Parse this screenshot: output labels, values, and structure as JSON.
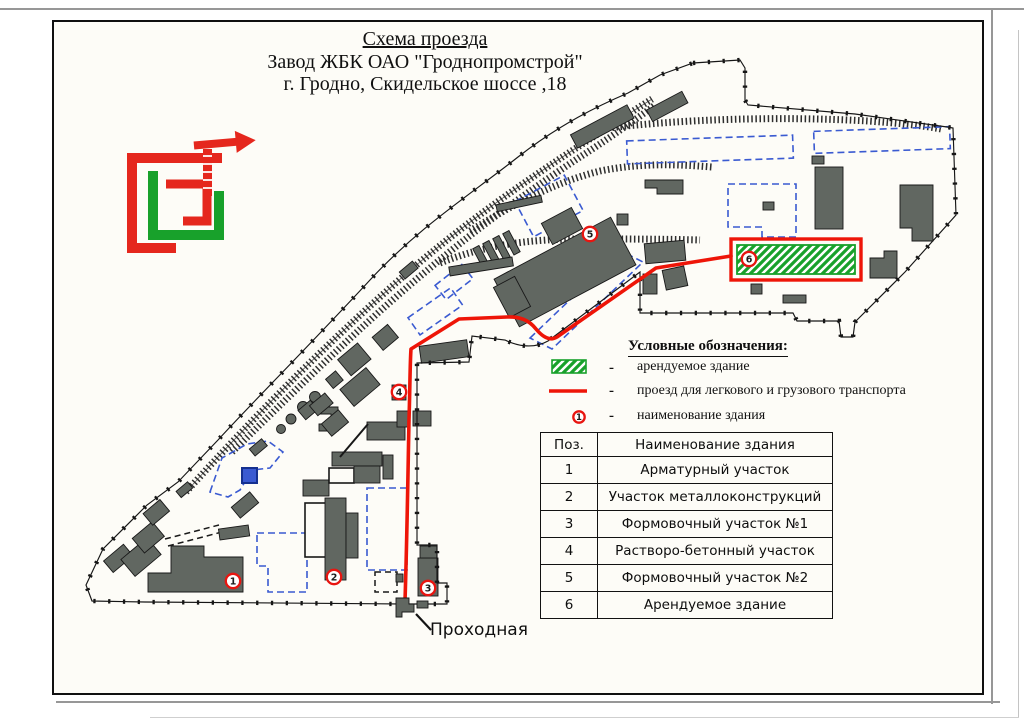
{
  "title": {
    "line1": "Схема проезда",
    "line2": "Завод ЖБК ОАО \"Гроднопромстрой\"",
    "line3": "г. Гродно, Скидельское шоссе ,18"
  },
  "legend": {
    "heading": "Условные обозначения:",
    "separator": "-",
    "items": [
      {
        "symbol": "rented-building-swatch",
        "label": "арендуемое здание"
      },
      {
        "symbol": "route-line-swatch",
        "label": "проезд для легкового и грузового транспорта"
      },
      {
        "symbol": "building-number-marker",
        "label": "наименование здания",
        "digit": "1"
      }
    ]
  },
  "table": {
    "headers": [
      "Поз.",
      "Наименование здания"
    ],
    "rows": [
      [
        "1",
        "Арматурный участок"
      ],
      [
        "2",
        "Участок металлоконструкций"
      ],
      [
        "3",
        "Формовочный участок №1"
      ],
      [
        "4",
        "Растворо-бетонный участок"
      ],
      [
        "5",
        "Формовочный участок №2"
      ],
      [
        "6",
        "Арендуемое здание"
      ]
    ]
  },
  "map": {
    "gate_label": "Проходная",
    "markers": [
      "1",
      "2",
      "3",
      "4",
      "5",
      "6"
    ]
  },
  "colors": {
    "route_red": "#ee1508",
    "dashed_blue": "#3a5ad1",
    "building_gray": "#616761",
    "hatch_green": "#18a12b",
    "boundary_black": "#161616",
    "logo_red": "#e5271d",
    "logo_green": "#18a12b"
  }
}
